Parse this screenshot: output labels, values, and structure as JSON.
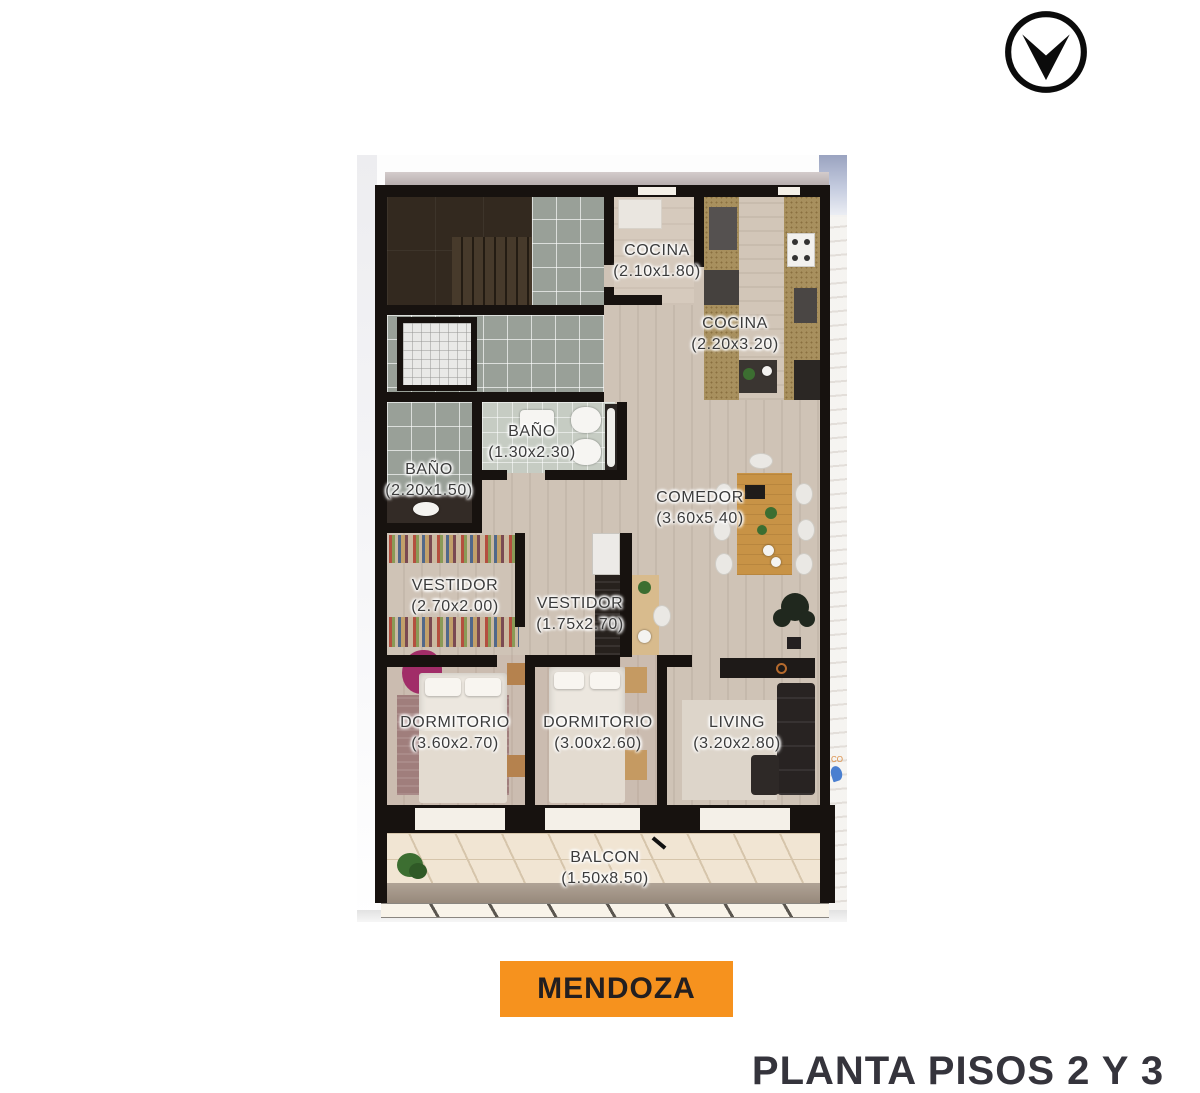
{
  "logo": {
    "shape": "v-arrow-in-circle"
  },
  "plan": {
    "rooms": [
      {
        "id": "cocina-1",
        "name": "COCINA",
        "dims": "(2.10x1.80)"
      },
      {
        "id": "cocina-2",
        "name": "COCINA",
        "dims": "(2.20x3.20)"
      },
      {
        "id": "bano-chico",
        "name": "BAÑO",
        "dims": "(1.30x2.30)"
      },
      {
        "id": "bano-grande",
        "name": "BAÑO",
        "dims": "(2.20x1.50)"
      },
      {
        "id": "comedor",
        "name": "COMEDOR",
        "dims": "(3.60x5.40)"
      },
      {
        "id": "vestidor-1",
        "name": "VESTIDOR",
        "dims": "(2.70x2.00)"
      },
      {
        "id": "vestidor-2",
        "name": "VESTIDOR",
        "dims": "(1.75x2.70)"
      },
      {
        "id": "dormitorio-1",
        "name": "DORMITORIO",
        "dims": "(3.60x2.70)"
      },
      {
        "id": "dormitorio-2",
        "name": "DORMITORIO",
        "dims": "(3.00x2.60)"
      },
      {
        "id": "living",
        "name": "LIVING",
        "dims": "(3.20x2.80)"
      },
      {
        "id": "balcon",
        "name": "BALCON",
        "dims": "(1.50x8.50)"
      }
    ],
    "watermark_text": "CO"
  },
  "location_button": {
    "label": "MENDOZA"
  },
  "footer": {
    "title": "PLANTA PISOS 2 Y 3"
  },
  "colors": {
    "accent_orange": "#F6921E",
    "button_text": "#231F20",
    "wall_black": "#17120F",
    "title_color": "#35343C"
  }
}
